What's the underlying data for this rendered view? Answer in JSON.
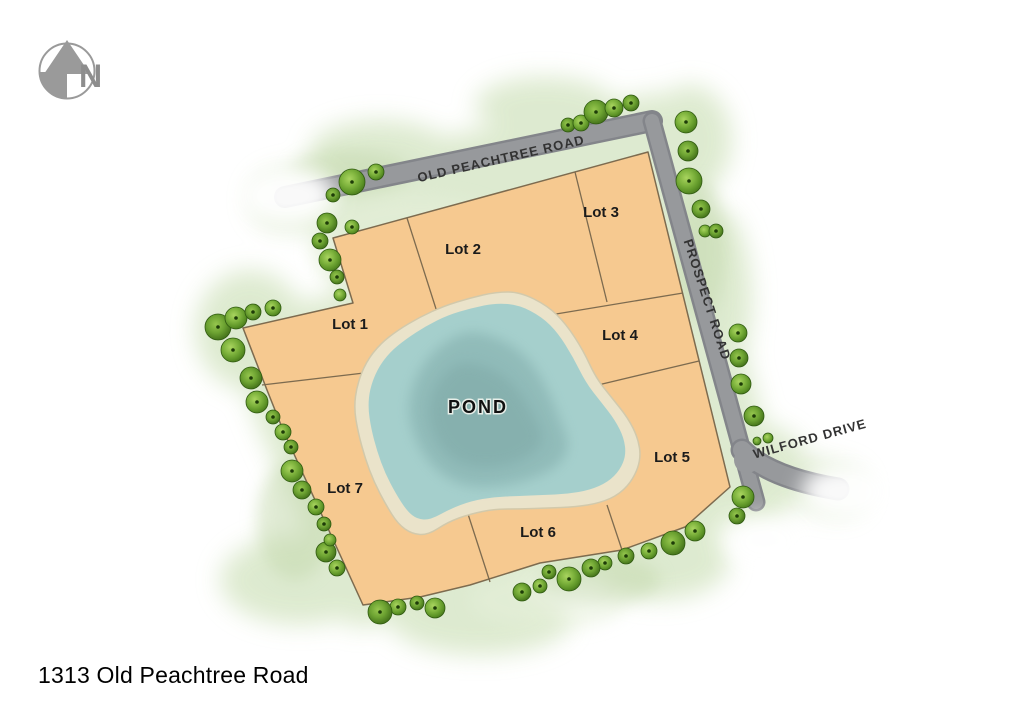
{
  "page": {
    "address": "1313 Old Peachtree Road"
  },
  "north": {
    "label": "N"
  },
  "colors": {
    "background": "#ffffff",
    "green_wash": "#d8e7c8",
    "green_wash_light": "#e6f0da",
    "green_wash_dark": "#c3d8ac",
    "road_fill": "#97999c",
    "road_edge": "#83858a",
    "lot_fill": "#f6c990",
    "lot_stroke": "#7d6b4f",
    "pond_sand": "#eae3ca",
    "pond_sand_stroke": "#d2c9ab",
    "pond_water": "#a5cfcc",
    "pond_deep": "#8db8b6",
    "pond_core": "#84aeac",
    "tree_stroke": "#2f5a10",
    "tree_dot": "#1e3c08",
    "label_color": "#1b1b1b",
    "road_label_color": "#333333",
    "north_gray": "#9a9a9a"
  },
  "map": {
    "parcel_outline": [
      [
        333,
        238
      ],
      [
        648,
        152
      ],
      [
        730,
        487
      ],
      [
        685,
        527
      ],
      [
        622,
        550
      ],
      [
        540,
        563
      ],
      [
        470,
        585
      ],
      [
        420,
        597
      ],
      [
        363,
        605
      ],
      [
        283,
        430
      ],
      [
        267,
        390
      ],
      [
        243,
        328
      ],
      [
        353,
        303
      ]
    ],
    "lot_lines": [
      [
        407,
        218,
        437,
        312
      ],
      [
        262,
        385,
        364,
        373
      ],
      [
        575,
        172,
        607,
        302
      ],
      [
        550,
        315,
        683,
        293
      ],
      [
        577,
        390,
        699,
        361
      ],
      [
        607,
        505,
        622,
        550
      ],
      [
        468,
        514,
        490,
        582
      ]
    ],
    "roads": [
      {
        "id": "old-peachtree-road",
        "kind": "line",
        "pts": [
          285,
          197,
          652,
          121
        ],
        "width": 20
      },
      {
        "id": "prospect-road",
        "kind": "line",
        "pts": [
          652,
          121,
          756,
          502
        ],
        "width": 17
      },
      {
        "id": "wilford-drive",
        "kind": "path",
        "d": "M742,450 C760,468 790,481 838,489",
        "width": 21
      }
    ],
    "road_labels": [
      {
        "id": "old-peachtree-road-label",
        "label": "OLD PEACHTREE ROAD",
        "x": 502,
        "y": 163,
        "rotate": -13,
        "size": 13
      },
      {
        "id": "prospect-road-label",
        "label": "PROSPECT ROAD",
        "x": 703,
        "y": 301,
        "rotate": 72,
        "size": 13
      },
      {
        "id": "wilford-drive-label",
        "label": "WILFORD DRIVE",
        "x": 811,
        "y": 443,
        "rotate": -15.5,
        "size": 13
      }
    ],
    "lot_labels": [
      {
        "id": "lot-1",
        "label": "Lot 1",
        "x": 350,
        "y": 329
      },
      {
        "id": "lot-2",
        "label": "Lot 2",
        "x": 463,
        "y": 254
      },
      {
        "id": "lot-3",
        "label": "Lot 3",
        "x": 601,
        "y": 217
      },
      {
        "id": "lot-4",
        "label": "Lot 4",
        "x": 620,
        "y": 340
      },
      {
        "id": "lot-5",
        "label": "Lot 5",
        "x": 672,
        "y": 462
      },
      {
        "id": "lot-6",
        "label": "Lot 6",
        "x": 538,
        "y": 537
      },
      {
        "id": "lot-7",
        "label": "Lot 7",
        "x": 345,
        "y": 493
      }
    ],
    "pond": {
      "label": "POND",
      "label_x": 478,
      "label_y": 413,
      "sand": [
        [
          520,
          292
        ],
        [
          548,
          306
        ],
        [
          566,
          324
        ],
        [
          583,
          350
        ],
        [
          596,
          378
        ],
        [
          612,
          398
        ],
        [
          628,
          418
        ],
        [
          638,
          438
        ],
        [
          641,
          458
        ],
        [
          634,
          478
        ],
        [
          620,
          494
        ],
        [
          600,
          503
        ],
        [
          575,
          507
        ],
        [
          548,
          508
        ],
        [
          520,
          509
        ],
        [
          495,
          509
        ],
        [
          470,
          514
        ],
        [
          448,
          522
        ],
        [
          428,
          535
        ],
        [
          412,
          534
        ],
        [
          398,
          524
        ],
        [
          386,
          505
        ],
        [
          374,
          482
        ],
        [
          365,
          458
        ],
        [
          358,
          432
        ],
        [
          354,
          408
        ],
        [
          357,
          385
        ],
        [
          366,
          362
        ],
        [
          380,
          344
        ],
        [
          398,
          330
        ],
        [
          420,
          317
        ],
        [
          444,
          306
        ],
        [
          470,
          298
        ],
        [
          496,
          292
        ]
      ],
      "water": [
        [
          519,
          305
        ],
        [
          542,
          317
        ],
        [
          558,
          333
        ],
        [
          573,
          357
        ],
        [
          586,
          383
        ],
        [
          601,
          402
        ],
        [
          615,
          420
        ],
        [
          624,
          438
        ],
        [
          626,
          455
        ],
        [
          620,
          470
        ],
        [
          608,
          482
        ],
        [
          590,
          490
        ],
        [
          567,
          494
        ],
        [
          543,
          495
        ],
        [
          518,
          496
        ],
        [
          494,
          497
        ],
        [
          471,
          501
        ],
        [
          450,
          509
        ],
        [
          430,
          520
        ],
        [
          417,
          519
        ],
        [
          407,
          511
        ],
        [
          396,
          494
        ],
        [
          385,
          473
        ],
        [
          377,
          451
        ],
        [
          371,
          428
        ],
        [
          368,
          407
        ],
        [
          370,
          388
        ],
        [
          378,
          368
        ],
        [
          390,
          352
        ],
        [
          406,
          339
        ],
        [
          426,
          326
        ],
        [
          448,
          315
        ],
        [
          472,
          308
        ],
        [
          496,
          303
        ]
      ],
      "deep": [
        [
          470,
          330
        ],
        [
          505,
          340
        ],
        [
          530,
          360
        ],
        [
          548,
          390
        ],
        [
          560,
          420
        ],
        [
          570,
          445
        ],
        [
          560,
          465
        ],
        [
          535,
          478
        ],
        [
          505,
          486
        ],
        [
          472,
          488
        ],
        [
          445,
          478
        ],
        [
          425,
          458
        ],
        [
          412,
          432
        ],
        [
          408,
          405
        ],
        [
          415,
          378
        ],
        [
          430,
          355
        ],
        [
          448,
          340
        ]
      ],
      "core": [
        [
          465,
          360
        ],
        [
          500,
          372
        ],
        [
          520,
          392
        ],
        [
          535,
          418
        ],
        [
          545,
          440
        ],
        [
          530,
          456
        ],
        [
          505,
          466
        ],
        [
          475,
          468
        ],
        [
          450,
          458
        ],
        [
          435,
          438
        ],
        [
          428,
          415
        ],
        [
          432,
          392
        ],
        [
          445,
          372
        ]
      ]
    },
    "trees": [
      [
        352,
        182,
        13
      ],
      [
        333,
        195,
        7
      ],
      [
        376,
        172,
        8
      ],
      [
        568,
        125,
        7
      ],
      [
        581,
        123,
        8
      ],
      [
        596,
        112,
        12
      ],
      [
        614,
        108,
        9
      ],
      [
        631,
        103,
        8
      ],
      [
        686,
        122,
        11
      ],
      [
        688,
        151,
        10
      ],
      [
        689,
        181,
        13
      ],
      [
        701,
        209,
        9
      ],
      [
        705,
        231,
        6
      ],
      [
        716,
        231,
        7
      ],
      [
        738,
        333,
        9
      ],
      [
        739,
        358,
        9
      ],
      [
        741,
        384,
        10
      ],
      [
        754,
        416,
        10
      ],
      [
        768,
        438,
        5
      ],
      [
        757,
        441,
        4
      ],
      [
        743,
        497,
        11
      ],
      [
        737,
        516,
        8
      ],
      [
        695,
        531,
        10
      ],
      [
        673,
        543,
        12
      ],
      [
        649,
        551,
        8
      ],
      [
        626,
        556,
        8
      ],
      [
        605,
        563,
        7
      ],
      [
        591,
        568,
        9
      ],
      [
        569,
        579,
        12
      ],
      [
        549,
        572,
        7
      ],
      [
        540,
        586,
        7
      ],
      [
        522,
        592,
        9
      ],
      [
        435,
        608,
        10
      ],
      [
        417,
        603,
        7
      ],
      [
        398,
        607,
        8
      ],
      [
        380,
        612,
        12
      ],
      [
        337,
        568,
        8
      ],
      [
        326,
        552,
        10
      ],
      [
        330,
        540,
        6
      ],
      [
        324,
        524,
        7
      ],
      [
        316,
        507,
        8
      ],
      [
        302,
        490,
        9
      ],
      [
        292,
        471,
        11
      ],
      [
        291,
        447,
        7
      ],
      [
        283,
        432,
        8
      ],
      [
        273,
        417,
        7
      ],
      [
        257,
        402,
        11
      ],
      [
        251,
        378,
        11
      ],
      [
        233,
        350,
        12
      ],
      [
        218,
        327,
        13
      ],
      [
        236,
        318,
        11
      ],
      [
        253,
        312,
        8
      ],
      [
        273,
        308,
        8
      ],
      [
        327,
        223,
        10
      ],
      [
        352,
        227,
        7
      ],
      [
        320,
        241,
        8
      ],
      [
        330,
        260,
        11
      ],
      [
        337,
        277,
        7
      ],
      [
        340,
        295,
        6
      ]
    ],
    "wash_ellipses": [
      [
        380,
        150,
        70,
        30
      ],
      [
        545,
        105,
        70,
        28
      ],
      [
        690,
        140,
        42,
        55
      ],
      [
        250,
        330,
        55,
        60
      ],
      [
        300,
        580,
        80,
        45
      ],
      [
        480,
        620,
        90,
        35
      ],
      [
        660,
        560,
        70,
        40
      ],
      [
        760,
        460,
        45,
        35
      ],
      [
        330,
        200,
        60,
        35
      ],
      [
        720,
        300,
        32,
        90
      ]
    ],
    "fog_ellipses": [
      [
        288,
        196,
        48,
        30
      ],
      [
        845,
        492,
        44,
        28
      ],
      [
        766,
        542,
        38,
        26
      ]
    ]
  }
}
